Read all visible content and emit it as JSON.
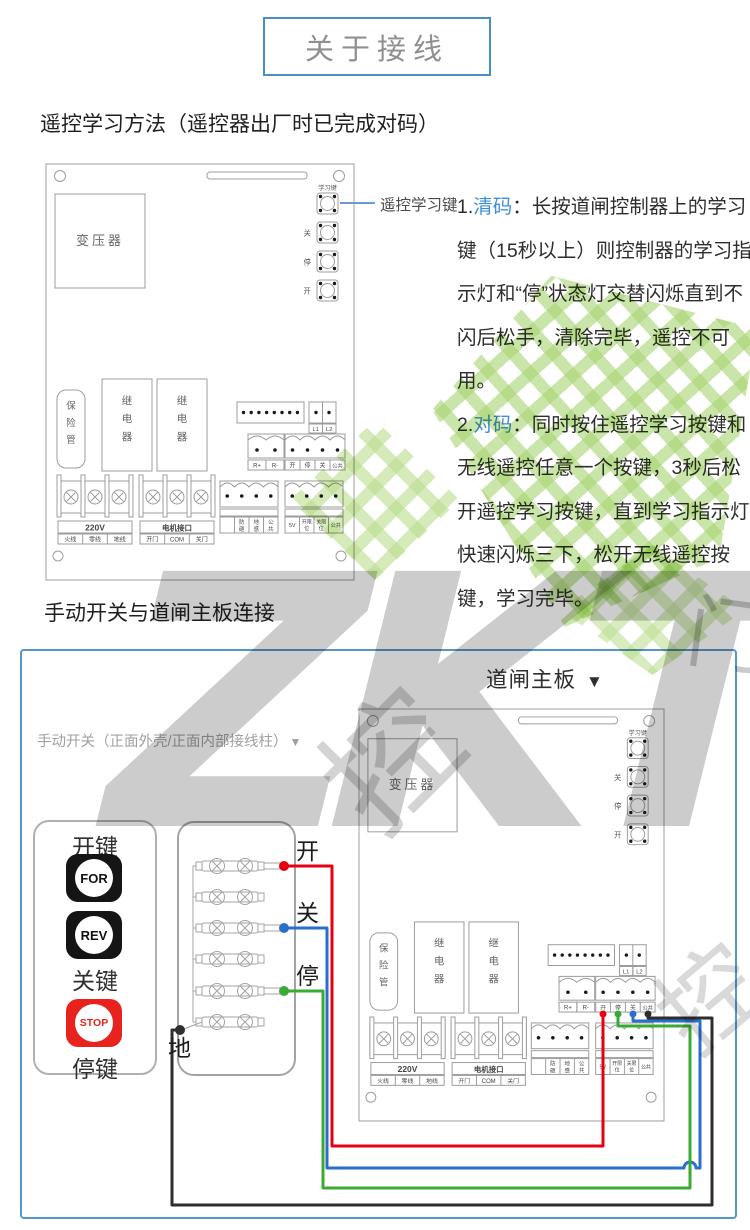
{
  "title": "关于接线",
  "section1": {
    "heading": "遥控学习方法（遥控器出厂时已完成对码）",
    "callout": "遥控学习键",
    "instructions": [
      {
        "num": "1.",
        "keyword": "清码",
        "rest": "：长按道闸控制器上的学习键（15秒以上）则控制器的学习指示灯和“停”状态灯交替闪烁直到不闪后松手，清除完毕，遥控不可用。"
      },
      {
        "num": "2.",
        "keyword": "对码",
        "rest": "：同时按住遥控学习按键和无线遥控任意一个按键，3秒后松开遥控学习按键，直到学习指示灯快速闪烁三下，松开无线遥控按键，学习完毕。"
      }
    ]
  },
  "section2": {
    "heading": "手动开关与道闸主板连接",
    "board_label": "道闸主板",
    "arrow": "▼",
    "switch_caption": "手动开关（正面外壳/正面内部接线柱）",
    "switch_panel": {
      "open_key": "开键",
      "close_key": "关键",
      "stop_key": "停键",
      "for_btn": "FOR",
      "rev_btn": "REV",
      "stop_btn": "STOP"
    },
    "wire_labels": {
      "open": "开",
      "close": "关",
      "stop": "停",
      "ground": "地"
    }
  },
  "board": {
    "transformer": "变压器",
    "learn_label": "学习键",
    "btn_close": "关",
    "btn_stop": "停",
    "btn_open": "开",
    "fuse_chars": [
      "保",
      "险",
      "管"
    ],
    "relay_chars": [
      "继",
      "电",
      "器"
    ],
    "l1": "L1",
    "l2": "L2",
    "r_plus": "R+",
    "r_minus": "R-",
    "io": [
      "开",
      "停",
      "关",
      "公共"
    ],
    "power": "220V",
    "power_row": [
      "火线",
      "零线",
      "地线"
    ],
    "motor": "电机接口",
    "motor_row": [
      "开门",
      "COM",
      "关门"
    ],
    "sensor_stack": [
      [
        "防",
        "砸"
      ],
      [
        "地",
        "感"
      ],
      [
        "公",
        "共"
      ]
    ],
    "limit_5v": "5V",
    "limit_stack": [
      [
        "开限",
        "位"
      ],
      [
        "关限",
        "位"
      ]
    ],
    "limit_common": "公共"
  },
  "watermark": {
    "letters": "ZKT",
    "char_1": "控",
    "char_2": "门",
    "char_3": "控"
  },
  "colors": {
    "title_border": "#4a8fc4",
    "keyword_blue": "#3d8fd6",
    "box_border": "#5795c6",
    "wire_red": "#e60012",
    "wire_blue": "#2a6fce",
    "wire_green": "#3aaa35",
    "wire_black": "#2e2e2e",
    "stop_button_red": "#e8231d",
    "watermark_green": "#8bc53f"
  }
}
